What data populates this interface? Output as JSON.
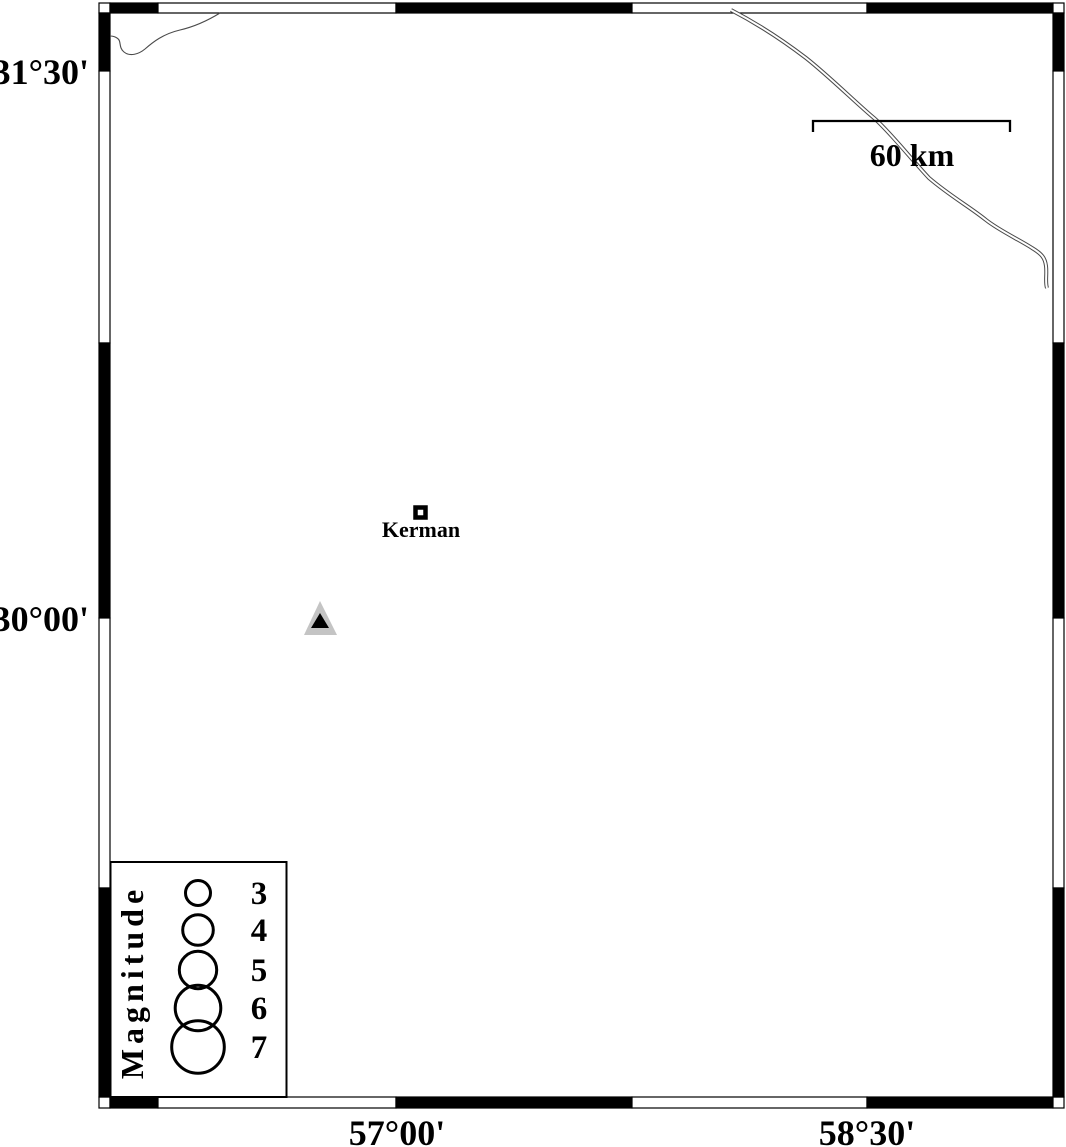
{
  "colors": {
    "ink": "#000000",
    "bg": "#ffffff",
    "station-gray": "#c4c4c4",
    "line-gray": "#4a4a4a"
  },
  "map": {
    "axes": {
      "left": [
        {
          "label": "31°30'"
        },
        {
          "label": "30°00'"
        }
      ],
      "bottom": [
        {
          "label": "57°00'"
        },
        {
          "label": "58°30'"
        }
      ]
    },
    "scalebar": {
      "label": "60 km"
    },
    "city": {
      "label": "Kerman"
    },
    "legend": {
      "title": "Magnitude",
      "entries": [
        {
          "label": "3"
        },
        {
          "label": "4"
        },
        {
          "label": "5"
        },
        {
          "label": "6"
        },
        {
          "label": "7"
        }
      ]
    }
  }
}
